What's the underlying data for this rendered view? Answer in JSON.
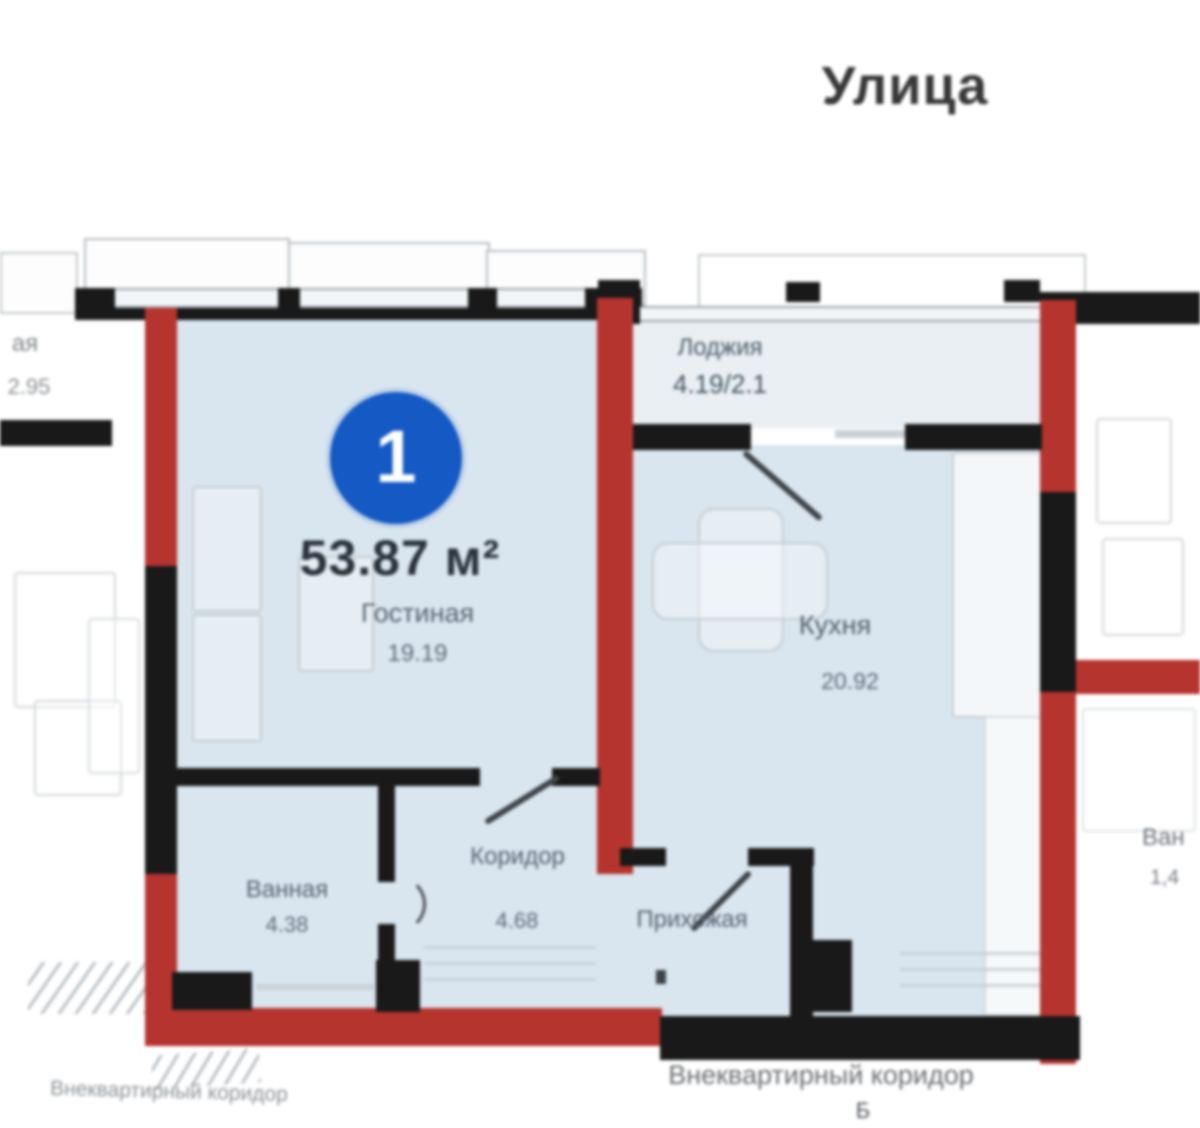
{
  "title": {
    "street": "Улица"
  },
  "unit": {
    "badge": "1",
    "total_area": "53.87 м²"
  },
  "rooms": {
    "living": {
      "name": "Гостиная",
      "area": "19.19"
    },
    "kitchen": {
      "name": "Кухня",
      "area": "20.92"
    },
    "loggia": {
      "name": "Лоджия",
      "area": "4.19/2.1"
    },
    "bath": {
      "name": "Ванная",
      "area": "4.38"
    },
    "corridor": {
      "name": "Коридор",
      "area": "4.68"
    },
    "hall": {
      "name": "Прихожая"
    }
  },
  "outside": {
    "common_corridor": "Внеквартирный коридор",
    "common_corridor_left": "Внеквартирный коридор",
    "stair_mark": "Б",
    "neighbor_left_line1": "ая",
    "neighbor_left_line2": "2.95",
    "neighbor_right_line1": "Ван",
    "neighbor_right_line2": "1,4"
  },
  "colors": {
    "wall_red": "#b5342e",
    "wall_black": "#191919",
    "room_fill": "#d9e5ef",
    "loggia_fill": "#e9eff3",
    "badge_blue": "#1459c4"
  }
}
